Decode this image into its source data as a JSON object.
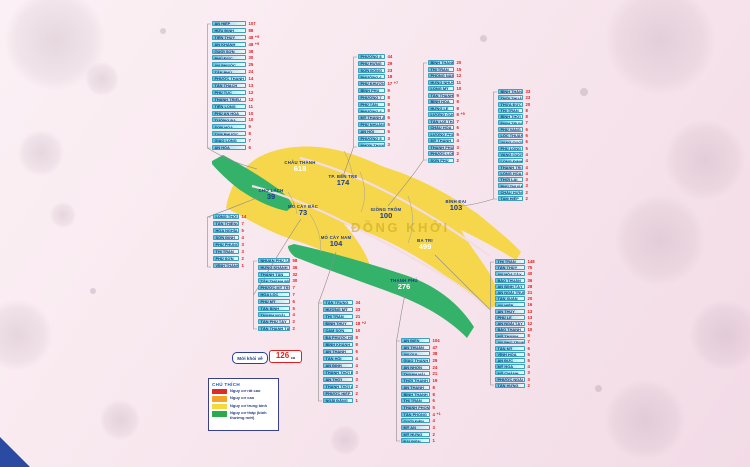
{
  "recovered": {
    "label": "Mới khỏi về",
    "value": "126",
    "unit": "ca"
  },
  "legend": {
    "title": "CHÚ THÍCH",
    "items": [
      {
        "label": "Nguy cơ rất cao",
        "color": "#e02a27"
      },
      {
        "label": "Nguy cơ cao",
        "color": "#f6a428"
      },
      {
        "label": "Nguy cơ trung bình",
        "color": "#f5d93d"
      },
      {
        "label": "Nguy cơ thấp (bình thường mới)",
        "color": "#2da84e"
      }
    ]
  },
  "map": {
    "watermark": "ĐỒNG KHỞI",
    "colors": {
      "medium_risk": "#f6d64a",
      "low_risk": "#35b26a"
    },
    "districts": [
      {
        "name": "CHÂU THÀNH",
        "cases": "618",
        "color": "#ffffff"
      },
      {
        "name": "TP. BẾN TRE",
        "cases": "174",
        "color": "#1a3a8f"
      },
      {
        "name": "GIỒNG TRÔM",
        "cases": "100",
        "color": "#1a3a8f"
      },
      {
        "name": "BÌNH ĐẠI",
        "cases": "103",
        "color": "#1a3a8f"
      },
      {
        "name": "BA TRI",
        "cases": "499",
        "color": "#ffffff"
      },
      {
        "name": "CHỢ LÁCH",
        "cases": "39",
        "color": "#1a3a8f"
      },
      {
        "name": "MỎ CÀY BẮC",
        "cases": "73",
        "color": "#1a3a8f"
      },
      {
        "name": "MỎ CÀY NAM",
        "cases": "104",
        "color": "#1a3a8f"
      },
      {
        "name": "THẠNH PHÚ",
        "cases": "276",
        "color": "#ffffff"
      }
    ]
  },
  "columns": [
    {
      "district": "Châu Thành",
      "items": [
        {
          "name": "AN HIỆP",
          "value": "107"
        },
        {
          "name": "HỮU ĐỊNH",
          "value": "88"
        },
        {
          "name": "TIÊN THỦY",
          "value": "48",
          "extra": "+9"
        },
        {
          "name": "AN KHÁNH",
          "value": "48",
          "extra": "+9"
        },
        {
          "name": "QUỚI SƠN",
          "value": "38"
        },
        {
          "name": "PHÚ ĐỨC",
          "value": "30"
        },
        {
          "name": "AN PHƯỚC",
          "value": "25"
        },
        {
          "name": "TÂN PHÚ",
          "value": "24"
        },
        {
          "name": "PHƯỚC THẠNH",
          "value": "14"
        },
        {
          "name": "TÂN THẠCH",
          "value": "13"
        },
        {
          "name": "PHÚ TÚC",
          "value": "12"
        },
        {
          "name": "THÀNH TRIỆU",
          "value": "12"
        },
        {
          "name": "TIÊN LONG",
          "value": "11"
        },
        {
          "name": "PHÚ AN HÒA",
          "value": "10"
        },
        {
          "name": "TƯỜNG ĐA",
          "value": "10"
        },
        {
          "name": "SƠN HÒA",
          "value": "9"
        },
        {
          "name": "TAM PHƯỚC",
          "value": "8"
        },
        {
          "name": "GIAO LONG",
          "value": "7"
        },
        {
          "name": "AN HÓA",
          "value": "6"
        }
      ]
    },
    {
      "district": "TP. Bến Tre",
      "items": [
        {
          "name": "PHƯỜNG 8",
          "value": "44"
        },
        {
          "name": "PHÚ HƯNG",
          "value": "29"
        },
        {
          "name": "SƠN ĐÔNG",
          "value": "23"
        },
        {
          "name": "PHƯỜNG 6",
          "value": "18"
        },
        {
          "name": "PHÚ KHƯƠNG",
          "value": "17",
          "extra": "+7"
        },
        {
          "name": "BÌNH PHÚ",
          "value": "9"
        },
        {
          "name": "PHƯỜNG 7",
          "value": "8"
        },
        {
          "name": "PHÚ TÂN",
          "value": "8"
        },
        {
          "name": "PHƯỜNG 4",
          "value": "8"
        },
        {
          "name": "MỸ THẠNH AN",
          "value": "6"
        },
        {
          "name": "PHÚ NHUẬN",
          "value": "5"
        },
        {
          "name": "AN HỘI",
          "value": "5"
        },
        {
          "name": "PHƯỜNG 5",
          "value": "3"
        },
        {
          "name": "NHƠN THẠNH",
          "value": "3"
        }
      ]
    },
    {
      "district": "Giồng Trôm",
      "items": [
        {
          "name": "BÌNH THÀNH",
          "value": "20"
        },
        {
          "name": "THỊ TRẤN",
          "value": "15"
        },
        {
          "name": "PHONG NẪM",
          "value": "12"
        },
        {
          "name": "HƯNG NHƯỢNG",
          "value": "11"
        },
        {
          "name": "LONG MỸ",
          "value": "10"
        },
        {
          "name": "TÂN THANH",
          "value": "9"
        },
        {
          "name": "BÌNH HÒA",
          "value": "8"
        },
        {
          "name": "HƯNG LỄ",
          "value": "8"
        },
        {
          "name": "LƯƠNG QUỚI",
          "value": "8",
          "extra": "+5"
        },
        {
          "name": "TÂN LỢI THẠNH",
          "value": "7"
        },
        {
          "name": "CHÂU HÒA",
          "value": "6"
        },
        {
          "name": "LƯƠNG PHÚ",
          "value": "5"
        },
        {
          "name": "MỸ THẠNH",
          "value": "4"
        },
        {
          "name": "THẠNH PHÚ ĐÔNG",
          "value": "3"
        },
        {
          "name": "PHƯỚC LONG",
          "value": "2"
        },
        {
          "name": "SƠN PHÚ",
          "value": "2"
        }
      ]
    },
    {
      "district": "Bình Đại",
      "items": [
        {
          "name": "BÌNH THẮNG",
          "value": "33"
        },
        {
          "name": "THỚI THUẬN",
          "value": "23"
        },
        {
          "name": "THỪA ĐỨC",
          "value": "20"
        },
        {
          "name": "THỊ TRẤN",
          "value": "8"
        },
        {
          "name": "BÌNH THỚI",
          "value": "8"
        },
        {
          "name": "ĐỊNH TRUNG",
          "value": "7"
        },
        {
          "name": "PHÚ VANG",
          "value": "6"
        },
        {
          "name": "LỘC THUẬN",
          "value": "6"
        },
        {
          "name": "VANG QUỚI TÂY",
          "value": "6"
        },
        {
          "name": "PHÚ LONG",
          "value": "5"
        },
        {
          "name": "VANG QUỚI ĐÔNG",
          "value": "4"
        },
        {
          "name": "LONG ĐỊNH",
          "value": "4"
        },
        {
          "name": "THẠNH TRỊ",
          "value": "4"
        },
        {
          "name": "LONG HÒA",
          "value": "4"
        },
        {
          "name": "THỚI LAI",
          "value": "3"
        },
        {
          "name": "PHÚ THUẬN",
          "value": "3"
        },
        {
          "name": "CHÂU HƯNG",
          "value": "2"
        },
        {
          "name": "TAM HIỆP",
          "value": "2"
        }
      ]
    },
    {
      "district": "Chợ Lách",
      "items": [
        {
          "name": "LONG THỚI",
          "value": "14"
        },
        {
          "name": "TÂN THIỀNG",
          "value": "7"
        },
        {
          "name": "HÒA NGHĨA",
          "value": "5"
        },
        {
          "name": "SƠN ĐỊNH",
          "value": "4"
        },
        {
          "name": "PHÚ PHỤNG",
          "value": "3"
        },
        {
          "name": "THỊ TRẤN",
          "value": "3"
        },
        {
          "name": "PHÚ SƠN",
          "value": "2"
        },
        {
          "name": "VĨNH THÀNH",
          "value": "1"
        }
      ]
    },
    {
      "district": "Mỏ Cày Bắc",
      "items": [
        {
          "name": "NHUẬN PHÚ TÂN",
          "value": "58"
        },
        {
          "name": "HƯNG KHÁNH TRUNG A",
          "value": "36"
        },
        {
          "name": "THANH TÂN",
          "value": "32"
        },
        {
          "name": "TÂN THÀNH BÌNH",
          "value": "30"
        },
        {
          "name": "PHƯỚC MỸ TRUNG",
          "value": "7"
        },
        {
          "name": "HÒA LỘC",
          "value": "7"
        },
        {
          "name": "PHÚ MỸ",
          "value": "6"
        },
        {
          "name": "TÂN BÌNH",
          "value": "5"
        },
        {
          "name": "THẠNH NGÃI",
          "value": "4"
        },
        {
          "name": "TÂN PHÚ TÂY",
          "value": "2"
        },
        {
          "name": "TÂN THANH TÂY",
          "value": "2"
        }
      ]
    },
    {
      "district": "Mỏ Cày Nam",
      "items": [
        {
          "name": "TÂN TRUNG",
          "value": "34"
        },
        {
          "name": "HƯƠNG MỸ",
          "value": "23"
        },
        {
          "name": "THỊ TRẤN",
          "value": "21"
        },
        {
          "name": "ĐỊNH THỦY",
          "value": "18",
          "extra": "+2"
        },
        {
          "name": "CẨM SƠN",
          "value": "10"
        },
        {
          "name": "ĐA PHƯỚC HỘI",
          "value": "8"
        },
        {
          "name": "BÌNH KHÁNH",
          "value": "8"
        },
        {
          "name": "AN THẠNH",
          "value": "6"
        },
        {
          "name": "TÂN HỘI",
          "value": "4"
        },
        {
          "name": "AN ĐỊNH",
          "value": "4"
        },
        {
          "name": "THÀNH THỚI B",
          "value": "3"
        },
        {
          "name": "AN THỚI",
          "value": "3"
        },
        {
          "name": "THÀNH THỚI A",
          "value": "2"
        },
        {
          "name": "PHƯỚC HIỆP",
          "value": "2"
        },
        {
          "name": "NGÃI ĐĂNG",
          "value": "1"
        }
      ]
    },
    {
      "district": "Thạnh Phú",
      "items": [
        {
          "name": "AN ĐIỀN",
          "value": "104"
        },
        {
          "name": "AN THUẬN",
          "value": "47"
        },
        {
          "name": "AN QUI",
          "value": "38"
        },
        {
          "name": "GIAO THẠNH",
          "value": "29"
        },
        {
          "name": "AN NHƠN",
          "value": "24"
        },
        {
          "name": "THẠNH HẢI",
          "value": "21"
        },
        {
          "name": "THỚI THẠNH",
          "value": "19"
        },
        {
          "name": "AN THẠNH",
          "value": "8"
        },
        {
          "name": "BÌNH THẠNH",
          "value": "8"
        },
        {
          "name": "THỊ TRẤN",
          "value": "6"
        },
        {
          "name": "THẠNH PHONG",
          "value": "5"
        },
        {
          "name": "TÂN PHONG",
          "value": "4",
          "extra": "+1"
        },
        {
          "name": "QUỚI ĐIỀN",
          "value": "4"
        },
        {
          "name": "MỸ AN",
          "value": "3"
        },
        {
          "name": "MỸ HƯNG",
          "value": "2"
        },
        {
          "name": "ĐẠI ĐIỀN",
          "value": "1"
        }
      ]
    },
    {
      "district": "Ba Tri",
      "items": [
        {
          "name": "THỊ TRẤN",
          "value": "148"
        },
        {
          "name": "TÂN THỦY",
          "value": "75"
        },
        {
          "name": "AN HÒA TÂY",
          "value": "40"
        },
        {
          "name": "BẢO THUẬN",
          "value": "36"
        },
        {
          "name": "AN BÌNH TÂY",
          "value": "28"
        },
        {
          "name": "AN NGÃI TRUNG",
          "value": "21"
        },
        {
          "name": "TÂN XUÂN",
          "value": "20"
        },
        {
          "name": "AN HIỆP",
          "value": "16"
        },
        {
          "name": "AN THỦY",
          "value": "13"
        },
        {
          "name": "PHÚ LỄ",
          "value": "13"
        },
        {
          "name": "AN NGÃI TÂY",
          "value": "12"
        },
        {
          "name": "BẢO THẠNH",
          "value": "10"
        },
        {
          "name": "MỸ THẠNH",
          "value": "8"
        },
        {
          "name": "AN PHÚ TRUNG",
          "value": "7"
        },
        {
          "name": "TÂN MỸ",
          "value": "6"
        },
        {
          "name": "VĨNH HÒA",
          "value": "5"
        },
        {
          "name": "AN ĐỨC",
          "value": "5"
        },
        {
          "name": "MỸ HÒA",
          "value": "4"
        },
        {
          "name": "MỸ CHÁNH",
          "value": "3"
        },
        {
          "name": "PHƯỚC NGÃI",
          "value": "3"
        },
        {
          "name": "TÂN HƯNG",
          "value": "2"
        }
      ]
    }
  ]
}
